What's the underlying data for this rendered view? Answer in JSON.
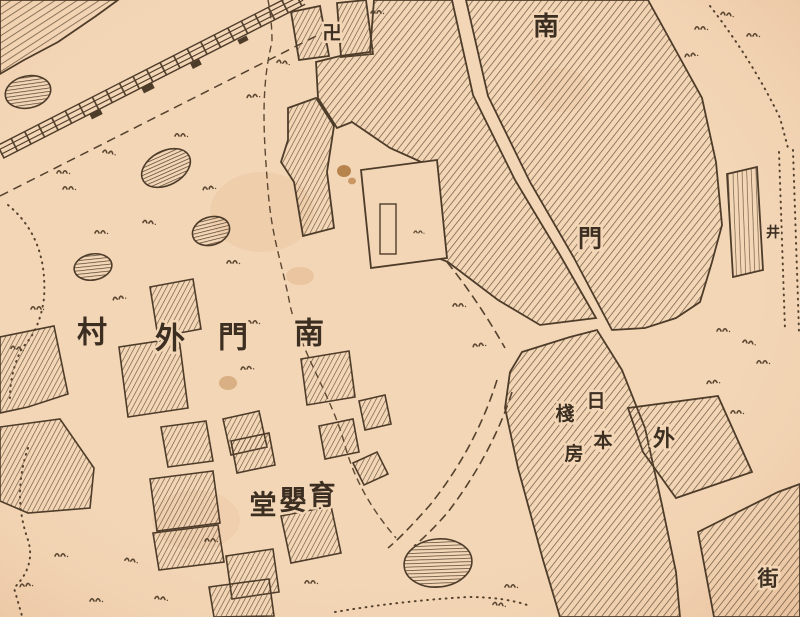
{
  "palette": {
    "paper": "#f3d6b6",
    "paper_shade": "#e9c19c",
    "ink": "#4e3c2a",
    "hatch": "#6b563e",
    "stain": "#b97f48"
  },
  "labels": {
    "village": {
      "text": "南門外村",
      "chars": [
        "村",
        "外",
        "門",
        "南"
      ]
    },
    "orphanage": {
      "text": "育嬰堂",
      "chars": [
        "堂",
        "嬰",
        "育"
      ]
    },
    "street": {
      "text": "南門外街",
      "chars": [
        "南",
        "門",
        "外",
        "街"
      ]
    },
    "warehouse": {
      "text": "日本棧房",
      "right_col": [
        "日",
        "本"
      ],
      "left_col": [
        "棧",
        "房"
      ]
    },
    "well": {
      "text": "井"
    },
    "temple": {
      "text": "卍"
    }
  }
}
